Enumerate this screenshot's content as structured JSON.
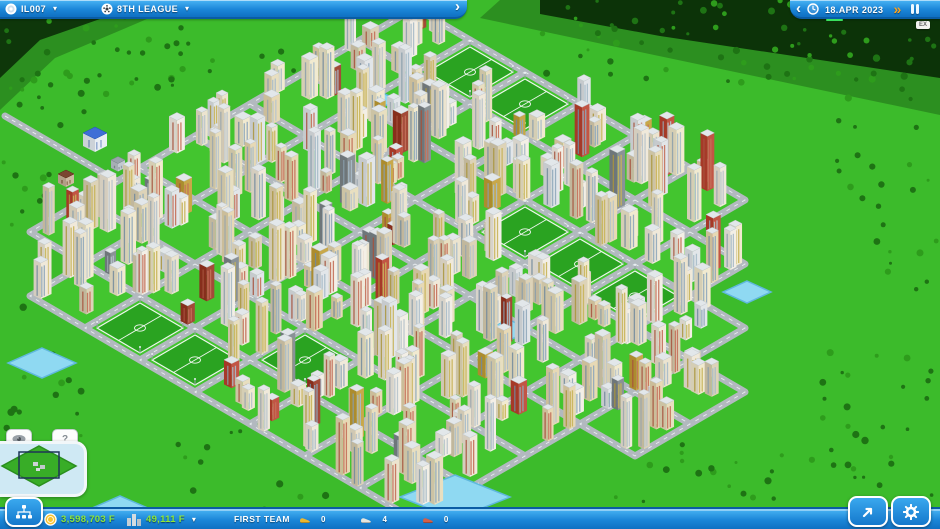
{
  "top_bar": {
    "profile": {
      "label": "IL007",
      "caret": "▾"
    },
    "league": {
      "label": "8TH LEAGUE",
      "caret": "▾"
    },
    "expand_chevron": "›",
    "right": {
      "collapse_chevron": "‹",
      "date": "18.APR 2023",
      "fast_forward": "»"
    },
    "corner_badge": "EX"
  },
  "bottom_bar": {
    "money": "3,598,703 F",
    "income": "49,111 F",
    "income_caret": "▾",
    "team_label": "FIRST TEAM",
    "boots": [
      {
        "name": "gold-boot",
        "count": "0",
        "color": "#edb72e"
      },
      {
        "name": "silver-boot",
        "count": "4",
        "color": "#e6e6de"
      },
      {
        "name": "red-boot",
        "count": "0",
        "color": "#d2604a"
      }
    ]
  },
  "minimap": {
    "help_label": "?"
  },
  "colors": {
    "bar_blue_top": "#4ab5f4",
    "bar_blue_bottom": "#0f70c2",
    "money_green": "#8ee73b",
    "date_underline": "#3ae05e",
    "fast_forward_orange": "#ffa41c"
  },
  "map": {
    "seed": 77,
    "colors": {
      "grass": "#3cbb2b",
      "block": "#43c52f",
      "road": "#b2b9bf",
      "road_dash": "#f0f4f6",
      "field": "#2aa321",
      "field_line": "#eef6ee",
      "water": "#8fd9f2",
      "water_edge": "#5fb8dd",
      "roof": "#e2e7ea",
      "tree_dark": "#1e7314",
      "tree_light": "#2e9c1c",
      "forest": "#0a2b08",
      "walls": [
        "#f3efe6",
        "#ece4cf",
        "#e7d9b5",
        "#f0e9da",
        "#e2e6e9",
        "#e8dfc0",
        "#f1ead0",
        "#ddd3b8"
      ],
      "accents": [
        "#c25544",
        "#a34a38",
        "#c8a84a",
        "#8a9296"
      ],
      "windows": [
        "#a8bcc9",
        "#c8b45a",
        "#c4705a",
        "#90a8bb",
        "#b8c4cc"
      ]
    },
    "grid": {
      "x0": 415,
      "y0": 40,
      "w": 55,
      "h": 32,
      "imax": 7,
      "jmax": 7,
      "exclude": [
        [
          0,
          7
        ],
        [
          6,
          0
        ],
        [
          7,
          0
        ],
        [
          7,
          1
        ]
      ],
      "extra": [
        [
          8,
          3
        ],
        [
          8,
          4
        ]
      ],
      "fields": [
        [
          1,
          0
        ],
        [
          2,
          0
        ],
        [
          4,
          2
        ],
        [
          5,
          2
        ],
        [
          6,
          2
        ],
        [
          2,
          7
        ],
        [
          3,
          7
        ],
        [
          4,
          6
        ]
      ]
    },
    "buildings": {
      "min": 5,
      "var": 4,
      "hmin": 18,
      "hvar": 40
    },
    "water": [
      [
        42,
        363,
        34,
        15
      ],
      [
        378,
        100,
        20,
        9
      ],
      [
        455,
        497,
        55,
        22
      ],
      [
        747,
        292,
        24,
        11
      ],
      [
        508,
        330,
        22,
        11
      ],
      [
        120,
        509,
        30,
        13
      ]
    ],
    "dark_patches": [
      {
        "pts": "540,0 940,0 940,78 660,36 540,14",
        "o": 0.92
      },
      {
        "pts": "500,0 940,0 940,115 640,52 480,18",
        "o": 0.3
      },
      {
        "pts": "0,0 150,0 120,12 40,40 0,78",
        "o": 0.88
      },
      {
        "pts": "0,0 190,0 140,22 55,58 0,110",
        "o": 0.3
      }
    ],
    "tree_regions": [
      [
        540,
        0,
        400,
        90,
        70
      ],
      [
        820,
        90,
        120,
        420,
        60
      ],
      [
        560,
        440,
        330,
        80,
        30
      ],
      [
        0,
        70,
        90,
        380,
        45
      ],
      [
        0,
        15,
        200,
        80,
        30
      ],
      [
        150,
        20,
        350,
        60,
        18
      ],
      [
        90,
        430,
        250,
        90,
        14
      ]
    ],
    "access_road": "5,116 170,212",
    "landmarks": [
      {
        "x": 95,
        "y": 146,
        "h": 13,
        "bw": 12,
        "wall": "#e8eef4",
        "roof": "#3f6fd6",
        "win": "#7e98c9"
      },
      {
        "x": 66,
        "y": 183,
        "h": 9,
        "bw": 8,
        "wall": "#cdbaa2",
        "roof": "#7a4631",
        "win": "#8a6a4e"
      },
      {
        "x": 118,
        "y": 168,
        "h": 8,
        "bw": 7,
        "wall": "#c2cad1",
        "roof": "#9aa4ac",
        "win": "#8f99a1"
      }
    ]
  }
}
